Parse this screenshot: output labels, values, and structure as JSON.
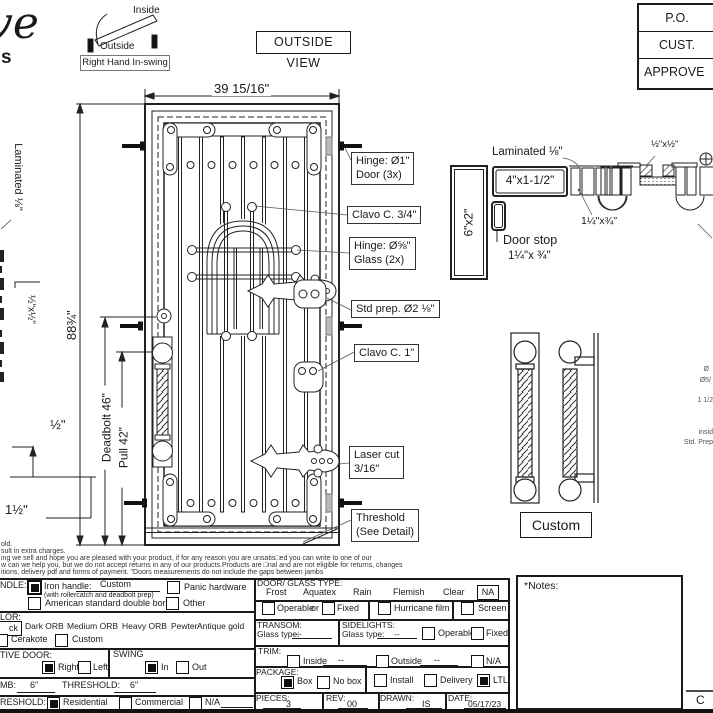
{
  "brand": {
    "script": "ve",
    "sub": "s"
  },
  "swing": {
    "inside": "Inside",
    "outside": "Outside",
    "label": "Right Hand In-swing"
  },
  "view_label": "OUTSIDE VIEW",
  "approval": {
    "rows": [
      "P.O.",
      "CUST.",
      "APPROVE"
    ]
  },
  "dims": {
    "width": "39 15/16\"",
    "height": "88¾\"",
    "deadbolt": "Deadbolt 46\"",
    "pull": "Pull 42\"",
    "laminated_left": "Laminated ⅛\"",
    "left_section": "½\"x½\"",
    "half": "½\"",
    "one_half": "1½\""
  },
  "annotations": [
    {
      "line1": "Hinge: Ø1\"",
      "line2": "Door (3x)"
    },
    {
      "line1": "Clavo C. 3/4\""
    },
    {
      "line1": "Hinge: Ø⅝\"",
      "line2": "Glass (2x)"
    },
    {
      "line1": "Std prep. Ø2 ⅛\""
    },
    {
      "line1": "Clavo C. 1\""
    },
    {
      "line1": "Laser cut",
      "line2": "3/16\""
    },
    {
      "line1": "Threshold",
      "line2": "(See Detail)"
    }
  ],
  "jamb": {
    "laminated": "Laminated ⅛\"",
    "jamb_size": "4\"x1-1/2\"",
    "frame_size": "6\"x2\"",
    "door_stop": "Door stop",
    "door_stop_size": "1¼\"x ¾\"",
    "stop_size": "1¼\"x¾\"",
    "corner_size": "½\"x½\""
  },
  "handle_detail": {
    "label": "Custom"
  },
  "edge_fragments": {
    "f1": "Ø",
    "f2": "Ø5/",
    "f3": "1 1/2",
    "f4": "insid",
    "f5": "Std. Prep"
  },
  "disclaimer": {
    "l1": "old.",
    "l2": "sult in extra charges.",
    "l3": "ing we sell and hope you are pleased with your product, if for any reason you are unsatis□ed you can write to one of our",
    "l4": "w can we help you, but we do not accept returns in any of our products.Products are □nal and are not eligible for returns, changes",
    "l5": "itions, delivery pdf and forms of payment. \"Doors measurements do not include the gaps between jambs"
  },
  "form": {
    "handle": {
      "label": "NDLE:",
      "iron": "Iron handle:",
      "iron_value": "Custom",
      "subnote": "(with rollercatch and deadbolt prep)",
      "panic": "Panic hardware",
      "american": "American standard double boring",
      "other": "Other"
    },
    "color": {
      "label": "LOR:",
      "fragment": "ck",
      "opt1": "Dark ORB",
      "opt2": "Medium ORB",
      "opt3": "Heavy ORB",
      "opt4": "Pewter",
      "opt5": "Antique gold",
      "cerakote": "Cerakote",
      "custom": "Custom"
    },
    "active": {
      "label": "TIVE DOOR:",
      "right": "Right",
      "left": "Left",
      "swing": "SWING",
      "in_label": "In",
      "out": "Out"
    },
    "jamb_row": {
      "label": "MB:",
      "value": "6\"",
      "threshold": "THRESHOLD:",
      "threshold_value": "6\""
    },
    "bottom_row": {
      "label": "RESHOLD:",
      "residential": "Residential",
      "commercial": "Commercial",
      "na": "N/A"
    },
    "glass": {
      "label": "DOOR/ GLASS TYPE:",
      "frost": "Frost",
      "aquatex": "Aquatex",
      "rain": "Rain",
      "flemish": "Flemish",
      "clear": "Clear",
      "na": "NA"
    },
    "operable_row": {
      "operable": "Operable",
      "or": "or",
      "fixed": "Fixed",
      "hurricane": "Hurricane film",
      "screen": "Screen"
    },
    "transom": {
      "label": "TRANSOM:",
      "glass_type": "Glass type:",
      "value": "--"
    },
    "sidelights": {
      "label": "SIDELIGHTS:",
      "glass_type": "Glass type:",
      "value": "--",
      "operable": "Operable",
      "fixed": "Fixed"
    },
    "trim": {
      "label": "TRIM:",
      "inside": "Inside",
      "inside_value": "--",
      "outside": "Outside",
      "outside_value": "--",
      "na": "N/A"
    },
    "package": {
      "label": "PACKAGE:",
      "box": "Box",
      "nobox": "No box",
      "install": "Install",
      "delivery": "Delivery",
      "ltl": "LTL"
    },
    "meta": {
      "pieces": "PIECES:",
      "pieces_value": "3",
      "rev": "REV:",
      "rev_value": "00",
      "drawn": "DRAWN:",
      "drawn_value": "IS",
      "date": "DATE:",
      "date_value": "05/17/23"
    },
    "checks": {
      "iron": true,
      "panic": false,
      "american": false,
      "other": false,
      "cerakote": false,
      "custom_color": false,
      "right": true,
      "left": false,
      "in_swing": true,
      "out": false,
      "residential": true,
      "commercial": false,
      "na_bottom": false,
      "operable": false,
      "fixed": false,
      "hurricane": false,
      "screen": false,
      "sl_operable": false,
      "sl_fixed": false,
      "trim_inside": false,
      "trim_outside": false,
      "trim_na": false,
      "box": true,
      "nobox": false,
      "install": false,
      "delivery": false,
      "ltl": true
    }
  },
  "notes": {
    "label": "*Notes:"
  },
  "corner": {
    "fragment": "C"
  }
}
